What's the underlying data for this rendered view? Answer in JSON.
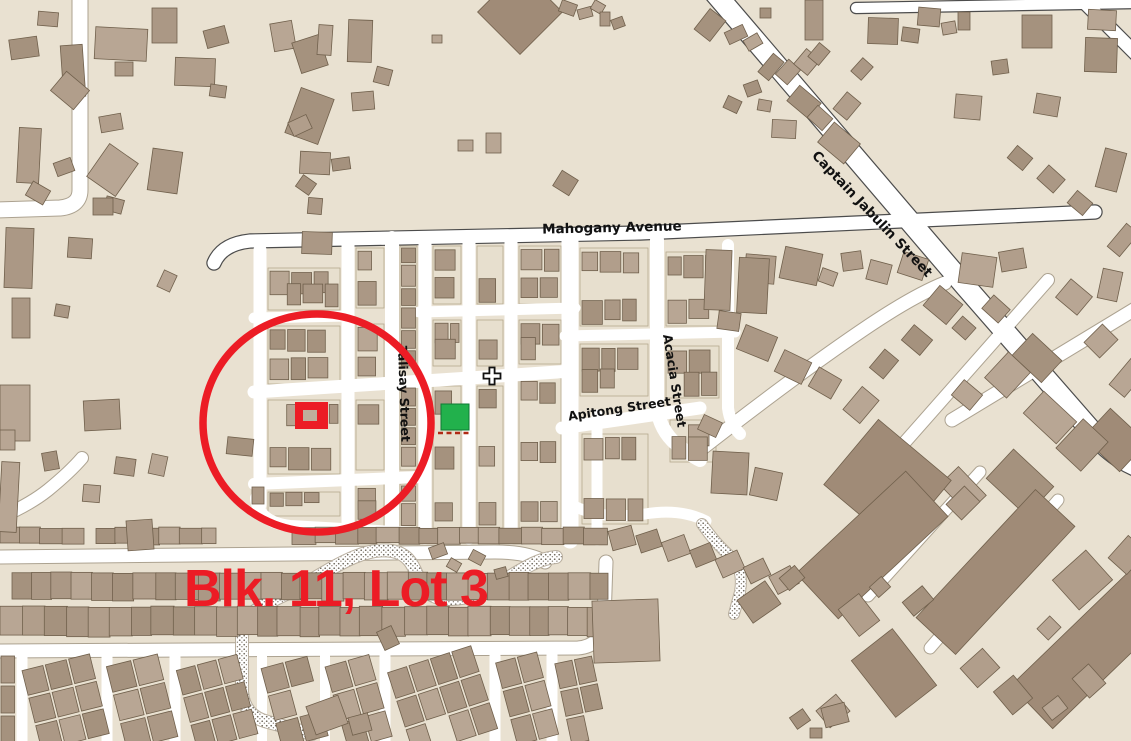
{
  "map": {
    "colors": {
      "background": "#e9e1d1",
      "block_fill": "#e7dfce",
      "building_fill": "#b19e8b",
      "building_outline": "#70604c",
      "road_fill": "#ffffff",
      "highlight_green": "#22b14c",
      "annotation_red": "#ec1c25"
    },
    "streets": {
      "mahogany_avenue": "Mahogany Avenue",
      "captain_jabulin_street": "Captain Jabulin Street",
      "talisay_street": "Talisay Street",
      "acacia_street": "Acacia Street",
      "apitong_street": "Apitong Street"
    },
    "landmarks": {
      "church_icon": "christian-cross",
      "highlighted_building": "green highlighted lot"
    },
    "annotation": {
      "label": "Blk. 11, Lot 3",
      "color": "#ec1c25"
    }
  }
}
